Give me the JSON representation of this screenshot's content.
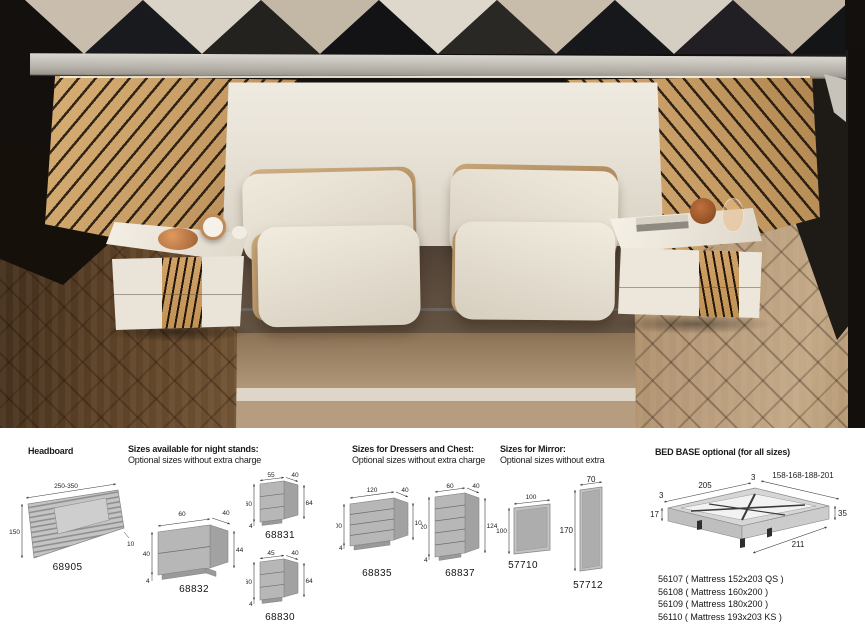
{
  "colors": {
    "wood_slats": "#c99f68",
    "headboard_white": "#e9e4da",
    "bedding_brown": "#584839",
    "bedding_tan": "#b29878",
    "floor_dark": "#5a4026",
    "floor_light": "#b59878",
    "diagram_gray": "#b7b7b7"
  },
  "sections": {
    "headboard": {
      "title": "Headboard",
      "code": "68905",
      "width": "250-350",
      "height": "150",
      "depth": "10"
    },
    "nightstands": {
      "title": "Sizes available for night stands:",
      "subtitle": "Optional sizes without extra charge",
      "items": [
        {
          "code": "68832",
          "top": "60",
          "depth": "40",
          "left": "40",
          "right": "44",
          "base": "4"
        },
        {
          "code": "68831",
          "top": "55",
          "depth": "40",
          "left": "60",
          "right": "64",
          "base": "4"
        },
        {
          "code": "68830",
          "top": "45",
          "depth": "40",
          "left": "60",
          "right": "64",
          "base": "4"
        }
      ]
    },
    "dressers": {
      "title": "Sizes for Dressers and Chest:",
      "subtitle": "Optional sizes without extra charge",
      "items": [
        {
          "code": "68835",
          "top": "120",
          "depth": "40",
          "left": "100",
          "right": "104",
          "base": "4"
        },
        {
          "code": "68837",
          "top": "60",
          "depth": "40",
          "left": "120",
          "right": "124",
          "base": "4"
        }
      ]
    },
    "mirror": {
      "title": "Sizes for Mirror:",
      "subtitle": "Optional sizes without extra",
      "items": [
        {
          "code": "57710",
          "width": "100",
          "height": "100"
        },
        {
          "code": "57712",
          "width": "70",
          "height": "170"
        }
      ]
    },
    "bedbase": {
      "title": "BED BASE optional (for all sizes)",
      "dims": {
        "length": "205",
        "widths": "158-168-188-201",
        "side_left": "3",
        "side_mid": "3",
        "frame_height": "17",
        "total_height": "35",
        "total_length": "211"
      },
      "models": [
        "56107 ( Mattress 152x203 QS )",
        "56108 ( Mattress 160x200 )",
        "56109 ( Mattress 180x200 )",
        "56110 ( Mattress 193x203 KS )"
      ]
    }
  }
}
